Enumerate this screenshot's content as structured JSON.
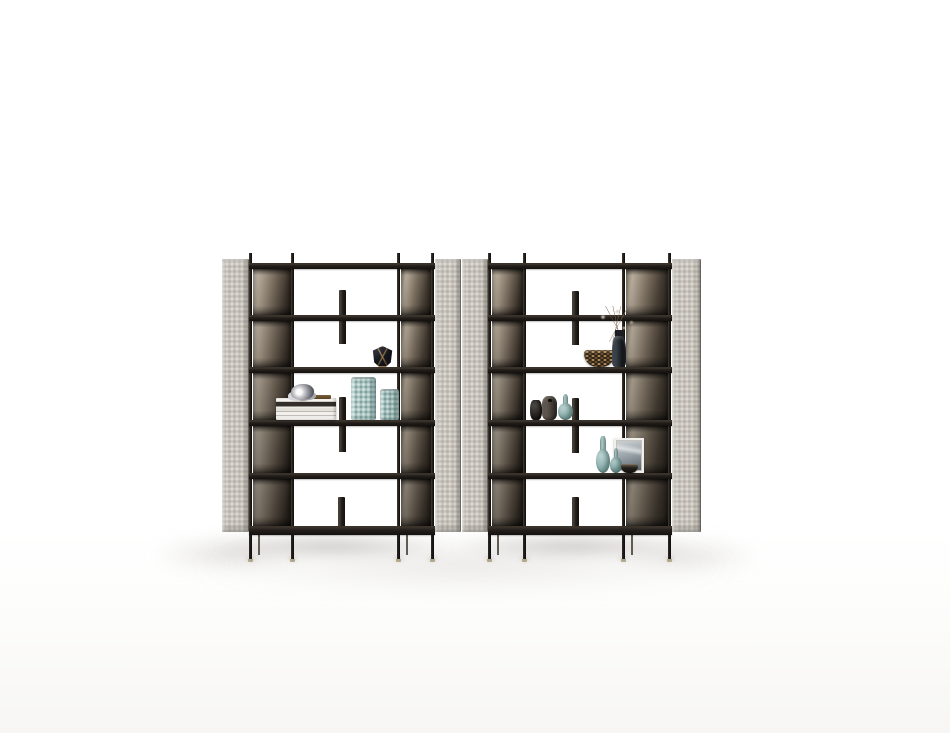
{
  "meta": {
    "description": "Studio product photo: two modern freestanding etagere bookcase units with taupe quilted side panels, smoked-bronze mirrored back sections, dark espresso shelves on thin black legs, styled with vases, books, bowls, dried flowers and an art frame on a white background"
  },
  "palette": {
    "panel_gray": "#c8c3bb",
    "wood_dark": "#241f1b",
    "wood_edge": "#3a332c",
    "metal_light": "#cdc4b5",
    "metal_dark": "#241f1a",
    "leg_black": "#141110",
    "foot_brass": "#b3a78c",
    "teal_glass": "#9cbbb8",
    "gold_trim": "#bd9559",
    "background": "#ffffff"
  },
  "scene": {
    "canvas": {
      "w": 950,
      "h": 733
    },
    "shelf_tops": [
      263,
      315,
      367,
      420,
      473,
      526
    ],
    "floor_shadows": [
      {
        "x": 190,
        "y": 543,
        "w": 550,
        "h": 44,
        "color": "rgba(188,184,178,0.40)",
        "blur": 13
      },
      {
        "x": 150,
        "y": 539,
        "w": 160,
        "h": 30,
        "color": "rgba(176,171,164,0.45)",
        "blur": 9
      },
      {
        "x": 608,
        "y": 541,
        "w": 155,
        "h": 30,
        "color": "rgba(182,177,170,0.40)",
        "blur": 9
      },
      {
        "x": 208,
        "y": 534,
        "w": 245,
        "h": 24,
        "color": "rgba(148,143,136,0.50)",
        "blur": 6
      },
      {
        "x": 452,
        "y": 534,
        "w": 245,
        "h": 24,
        "color": "rgba(148,143,136,0.50)",
        "blur": 6
      }
    ]
  },
  "units": [
    {
      "id": "bookcase-left",
      "geometry": {
        "panel_y": 259,
        "panel_h": 273,
        "post_y": 253,
        "post_w": 3,
        "leg_y": 535,
        "leg_h": 24,
        "back_leg_h": 20,
        "shelf_x": 249,
        "shelf_w": 186,
        "shelf_h": 6,
        "bottom_shelf_h": 9,
        "posts": [
          249,
          291,
          397,
          431
        ],
        "legs": [
          249,
          291,
          397,
          431
        ],
        "back_legs": [
          258,
          406
        ]
      },
      "side_panels": [
        {
          "x": 222,
          "w": 27
        },
        {
          "x": 435,
          "w": 26
        }
      ],
      "metal_backs": [
        {
          "side": "left",
          "x": 253,
          "w": 38
        },
        {
          "side": "right",
          "x": 401,
          "w": 30
        }
      ],
      "fins": [
        {
          "x": 339,
          "y": 290,
          "w": 7,
          "h": 54
        },
        {
          "x": 339,
          "y": 397,
          "w": 7,
          "h": 55
        },
        {
          "x": 338,
          "y": 497,
          "w": 7,
          "h": 29
        }
      ],
      "decor": [
        {
          "type": "faceted",
          "name": "decor-faceted-vase",
          "x": 371,
          "y": 346,
          "w": 23,
          "h": 21
        },
        {
          "type": "books",
          "name": "decor-book-stack",
          "x": 276,
          "y": 398,
          "w": 60,
          "h": 22
        },
        {
          "type": "chrome",
          "name": "decor-chrome-ornament",
          "x": 291,
          "y": 384,
          "w": 23,
          "h": 16
        },
        {
          "type": "texvase",
          "name": "decor-textured-vase-tall",
          "x": 351,
          "y": 377,
          "w": 25,
          "h": 43,
          "c1": "#a9c6c3"
        },
        {
          "type": "texvase",
          "name": "decor-textured-vase-short",
          "x": 380,
          "y": 389,
          "w": 19,
          "h": 31,
          "c1": "#9cbbb8"
        }
      ]
    },
    {
      "id": "bookcase-right",
      "geometry": {
        "panel_y": 259,
        "panel_h": 273,
        "post_y": 253,
        "post_w": 3,
        "leg_y": 535,
        "leg_h": 24,
        "back_leg_h": 20,
        "shelf_x": 488,
        "shelf_w": 184,
        "shelf_h": 6,
        "bottom_shelf_h": 9,
        "posts": [
          488,
          523,
          622,
          668
        ],
        "legs": [
          488,
          523,
          622,
          668
        ],
        "back_legs": [
          497,
          631
        ]
      },
      "side_panels": [
        {
          "x": 462,
          "w": 26
        },
        {
          "x": 672,
          "w": 29
        }
      ],
      "metal_backs": [
        {
          "side": "left",
          "x": 492,
          "w": 31
        },
        {
          "side": "right",
          "x": 626,
          "w": 42
        }
      ],
      "fins": [
        {
          "x": 572,
          "y": 291,
          "w": 7,
          "h": 54
        },
        {
          "x": 572,
          "y": 398,
          "w": 7,
          "h": 55
        },
        {
          "x": 572,
          "y": 497,
          "w": 7,
          "h": 29
        }
      ],
      "decor": [
        {
          "type": "wovenbowl",
          "name": "decor-woven-bowl",
          "x": 584,
          "y": 350,
          "w": 31,
          "h": 17
        },
        {
          "type": "flowers",
          "name": "decor-dried-flowers",
          "x": 594,
          "y": 306,
          "w": 46,
          "h": 61
        },
        {
          "type": "darkvase",
          "name": "decor-black-vase",
          "x": 530,
          "y": 400,
          "w": 12,
          "h": 20,
          "c1": "#1d1a17"
        },
        {
          "type": "darkbottle",
          "name": "decor-stone-vessel",
          "x": 542,
          "y": 396,
          "w": 15,
          "h": 24,
          "c1": "#3d3630"
        },
        {
          "type": "gourd",
          "name": "decor-teal-gourd-vase",
          "x": 558,
          "y": 394,
          "w": 15,
          "h": 26,
          "c1": "#8fb3b0"
        },
        {
          "type": "frame",
          "name": "decor-art-frame",
          "x": 614,
          "y": 438,
          "w": 30,
          "h": 35
        },
        {
          "type": "gourd",
          "name": "decor-teal-gourd-tall",
          "x": 596,
          "y": 436,
          "w": 14,
          "h": 37,
          "c1": "#93b7b4"
        },
        {
          "type": "gourd",
          "name": "decor-teal-gourd-short",
          "x": 610,
          "y": 448,
          "w": 12,
          "h": 25,
          "c1": "#86aba8"
        },
        {
          "type": "bowl",
          "name": "decor-small-bowl",
          "x": 621,
          "y": 464,
          "w": 17,
          "h": 9
        }
      ]
    }
  ]
}
